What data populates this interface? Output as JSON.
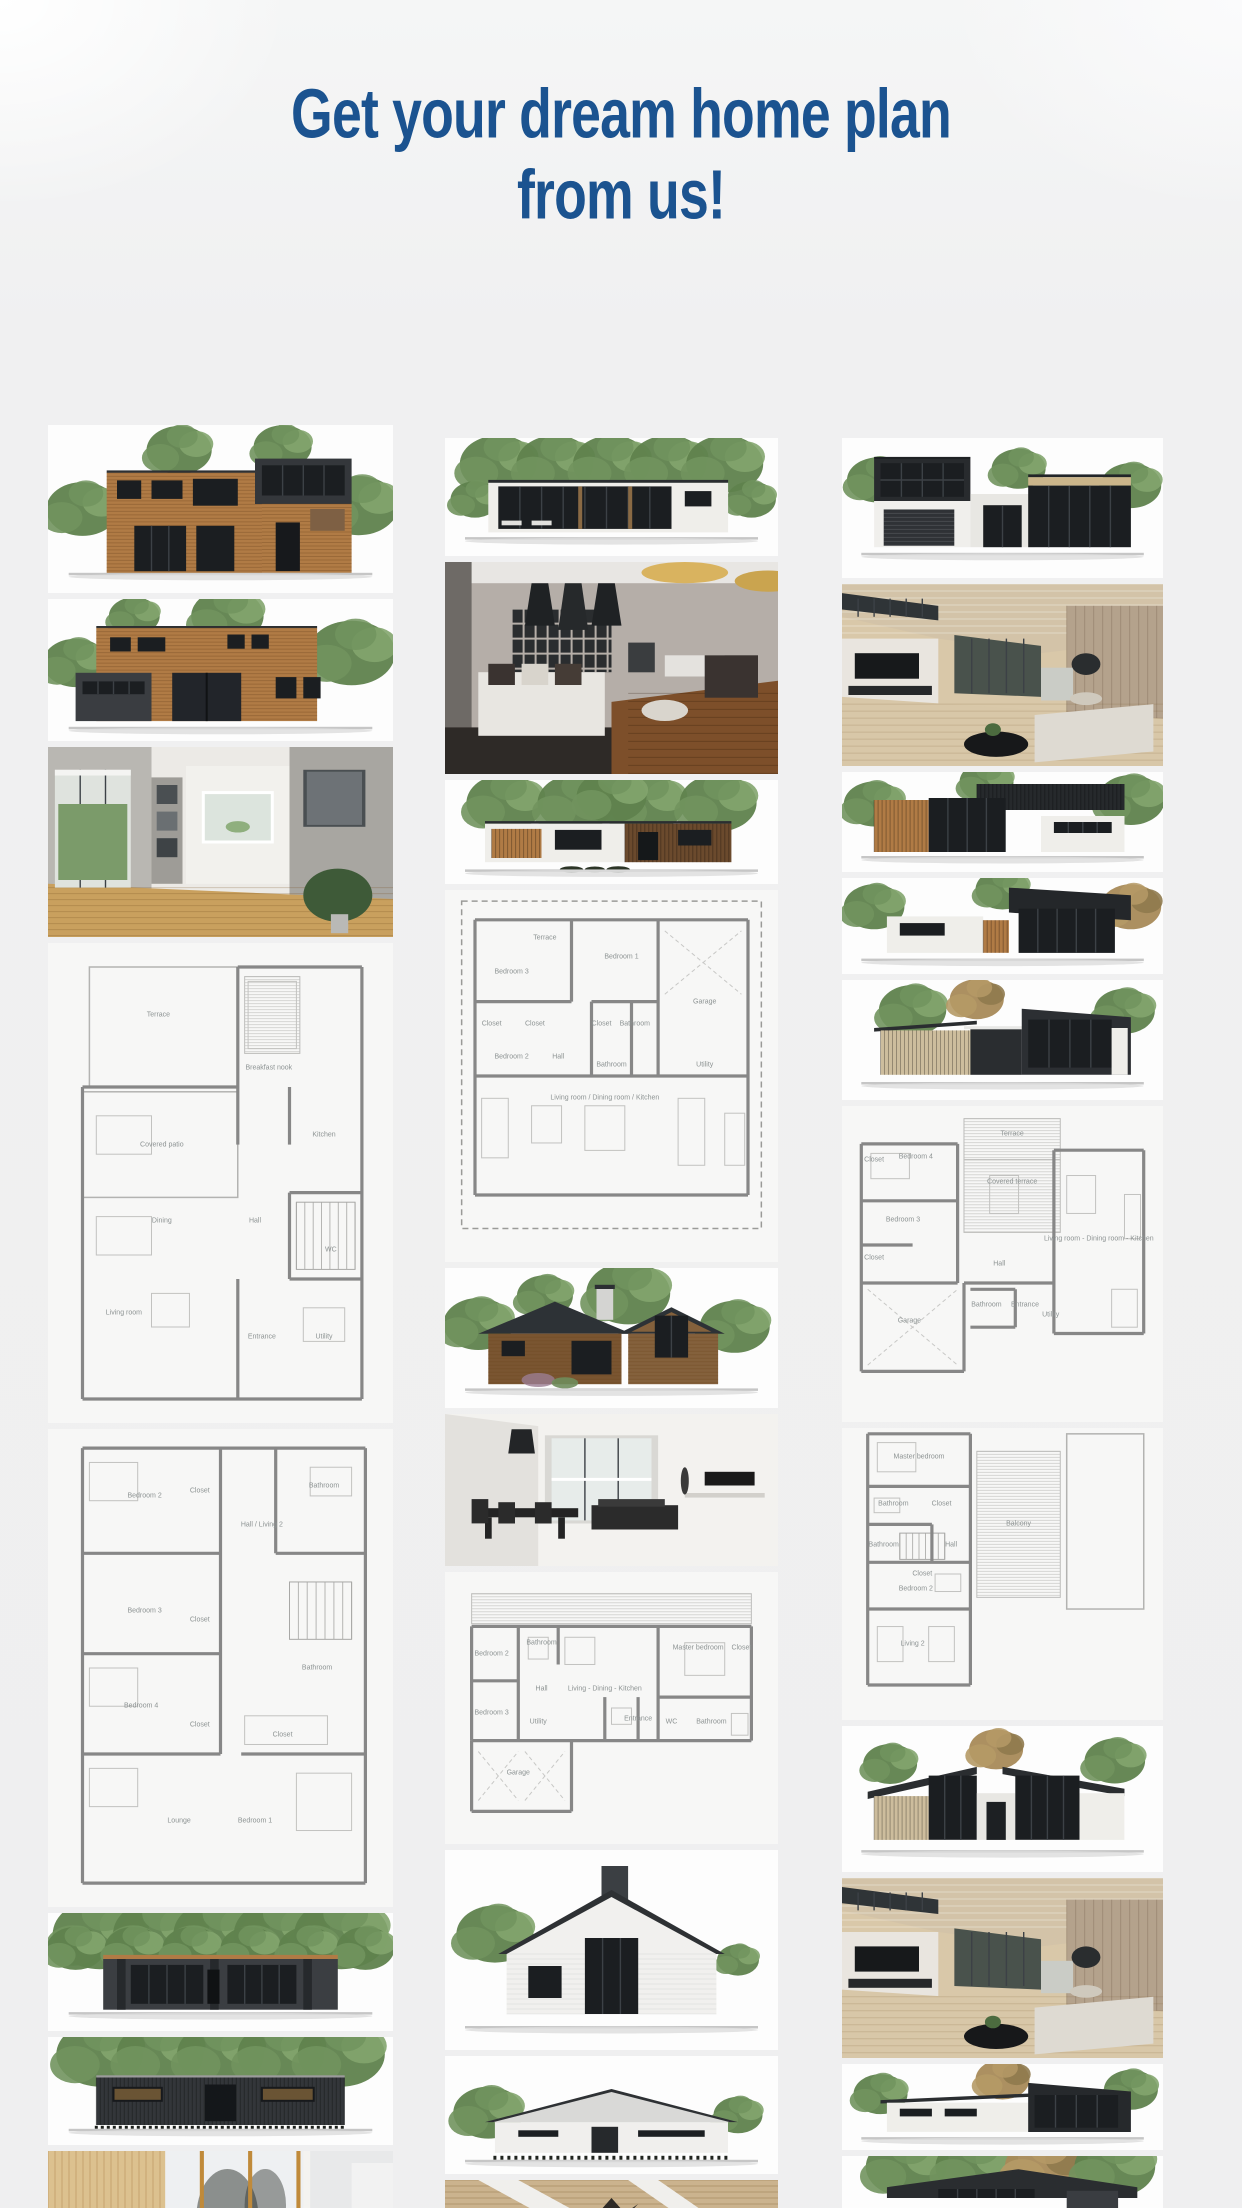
{
  "page": {
    "title": {
      "line1": "Get your dream home plan",
      "line2": "from us!"
    },
    "colors": {
      "title": "#1b5390",
      "background": "#efeff0",
      "plan_wall": "#878787",
      "wood": "#b07b45",
      "tree_green": "#6b8f5a",
      "dark_facade": "#35383c"
    }
  },
  "gallery": {
    "columns": [
      {
        "id": "left",
        "items": [
          {
            "name": "wood-two-story-house-render",
            "type": "render",
            "style": "woodhouseA"
          },
          {
            "name": "wood-house-dark-garage-render",
            "type": "render",
            "style": "woodhouseB"
          },
          {
            "name": "bright-interior-photo",
            "type": "interior",
            "style": "interiorLight"
          },
          {
            "name": "floor-plan-first-floor",
            "type": "plan",
            "plan": "c1f1",
            "rooms": [
              {
                "label": "Terrace",
                "x": 32,
                "y": 15
              },
              {
                "label": "Breakfast nook",
                "x": 64,
                "y": 26
              },
              {
                "label": "Covered patio",
                "x": 33,
                "y": 42
              },
              {
                "label": "Kitchen",
                "x": 80,
                "y": 40
              },
              {
                "label": "Dining",
                "x": 33,
                "y": 58
              },
              {
                "label": "Hall",
                "x": 60,
                "y": 58
              },
              {
                "label": "WC",
                "x": 82,
                "y": 64
              },
              {
                "label": "Living room",
                "x": 22,
                "y": 77
              },
              {
                "label": "Entrance",
                "x": 62,
                "y": 82
              },
              {
                "label": "Utility",
                "x": 80,
                "y": 82
              }
            ]
          },
          {
            "name": "floor-plan-second-floor",
            "type": "plan",
            "plan": "c1f2",
            "rooms": [
              {
                "label": "Bedroom 2",
                "x": 28,
                "y": 14
              },
              {
                "label": "Closet",
                "x": 44,
                "y": 13
              },
              {
                "label": "Hall / Living 2",
                "x": 62,
                "y": 20
              },
              {
                "label": "Bathroom",
                "x": 80,
                "y": 12
              },
              {
                "label": "Bedroom 3",
                "x": 28,
                "y": 38
              },
              {
                "label": "Closet",
                "x": 44,
                "y": 40
              },
              {
                "label": "Bedroom 4",
                "x": 27,
                "y": 58
              },
              {
                "label": "Closet",
                "x": 44,
                "y": 62
              },
              {
                "label": "Bathroom",
                "x": 78,
                "y": 50
              },
              {
                "label": "Closet",
                "x": 68,
                "y": 64
              },
              {
                "label": "Lounge",
                "x": 38,
                "y": 82
              },
              {
                "label": "Bedroom 1",
                "x": 60,
                "y": 82
              }
            ]
          },
          {
            "name": "dark-house-roof-trees-render",
            "type": "render",
            "style": "darkwideA"
          },
          {
            "name": "dark-house-elevation-render",
            "type": "render",
            "style": "darkwideB"
          },
          {
            "name": "wood-pillar-interior-photo",
            "type": "interior",
            "style": "interiorWoodPillars"
          }
        ]
      },
      {
        "id": "middle",
        "items": [
          {
            "name": "flat-roof-glass-house-render",
            "type": "render",
            "style": "flatwideWhite"
          },
          {
            "name": "dark-living-room-interior-photo",
            "type": "interior",
            "style": "interiorDark"
          },
          {
            "name": "white-wood-flat-house-render",
            "type": "render",
            "style": "flatwideWood"
          },
          {
            "name": "single-story-floor-plan",
            "type": "plan",
            "plan": "c2a",
            "rooms": [
              {
                "label": "Terrace",
                "x": 30,
                "y": 13
              },
              {
                "label": "Bedroom 1",
                "x": 53,
                "y": 18
              },
              {
                "label": "Garage",
                "x": 78,
                "y": 30
              },
              {
                "label": "Bedroom 3",
                "x": 20,
                "y": 22
              },
              {
                "label": "Closet",
                "x": 14,
                "y": 36
              },
              {
                "label": "Closet",
                "x": 27,
                "y": 36
              },
              {
                "label": "Closet",
                "x": 47,
                "y": 36
              },
              {
                "label": "Bathroom",
                "x": 57,
                "y": 36
              },
              {
                "label": "Bedroom 2",
                "x": 20,
                "y": 45
              },
              {
                "label": "Hall",
                "x": 34,
                "y": 45
              },
              {
                "label": "Bathroom",
                "x": 50,
                "y": 47
              },
              {
                "label": "Utility",
                "x": 78,
                "y": 47
              },
              {
                "label": "Living room / Dining room / Kitchen",
                "x": 48,
                "y": 56
              }
            ]
          },
          {
            "name": "gable-wood-house-render",
            "type": "render",
            "style": "gableWood"
          },
          {
            "name": "white-dining-interior-photo",
            "type": "interior",
            "style": "interiorWhite"
          },
          {
            "name": "wide-floor-plan-with-garage",
            "type": "plan",
            "plan": "c2b",
            "rooms": [
              {
                "label": "Bedroom 2",
                "x": 14,
                "y": 30
              },
              {
                "label": "Bathroom",
                "x": 29,
                "y": 26
              },
              {
                "label": "Hall",
                "x": 29,
                "y": 43
              },
              {
                "label": "Living - Dining - Kitchen",
                "x": 48,
                "y": 43
              },
              {
                "label": "Master bedroom",
                "x": 76,
                "y": 28
              },
              {
                "label": "Closet",
                "x": 89,
                "y": 28
              },
              {
                "label": "Bedroom 3",
                "x": 14,
                "y": 52
              },
              {
                "label": "Utility",
                "x": 28,
                "y": 55
              },
              {
                "label": "Entrance",
                "x": 58,
                "y": 54
              },
              {
                "label": "WC",
                "x": 68,
                "y": 55
              },
              {
                "label": "Bathroom",
                "x": 80,
                "y": 55
              },
              {
                "label": "Garage",
                "x": 22,
                "y": 74
              }
            ]
          },
          {
            "name": "white-gable-house-chimney-render",
            "type": "render",
            "style": "gableWhiteChimney"
          },
          {
            "name": "white-gable-house-render",
            "type": "render",
            "style": "gableWhiteB"
          },
          {
            "name": "wood-ceiling-interior-photo",
            "type": "interior",
            "style": "interiorWoodCeil"
          }
        ]
      },
      {
        "id": "right",
        "items": [
          {
            "name": "black-glass-modern-house-render",
            "type": "render",
            "style": "blackmixA"
          },
          {
            "name": "wood-cathedral-interior-photo",
            "type": "interior",
            "style": "interiorCathedral"
          },
          {
            "name": "black-wood-modern-house-render",
            "type": "render",
            "style": "blackmixB"
          },
          {
            "name": "black-modern-house-render",
            "type": "render",
            "style": "blackmixC"
          },
          {
            "name": "slant-roof-modern-house-render",
            "type": "render",
            "style": "slantHouseA"
          },
          {
            "name": "two-story-floor-plan-first-floor",
            "type": "plan",
            "plan": "c3f1",
            "rooms": [
              {
                "label": "Closet",
                "x": 10,
                "y": 17
              },
              {
                "label": "Bedroom 4",
                "x": 23,
                "y": 16
              },
              {
                "label": "Terrace",
                "x": 53,
                "y": 9
              },
              {
                "label": "Covered terrace",
                "x": 53,
                "y": 24
              },
              {
                "label": "Bedroom 3",
                "x": 19,
                "y": 36
              },
              {
                "label": "Closet",
                "x": 10,
                "y": 48
              },
              {
                "label": "Living room - Dining room - Kitchen",
                "x": 80,
                "y": 42
              },
              {
                "label": "Garage",
                "x": 21,
                "y": 68
              },
              {
                "label": "Hall",
                "x": 49,
                "y": 50
              },
              {
                "label": "Bathroom",
                "x": 45,
                "y": 63
              },
              {
                "label": "Entrance",
                "x": 57,
                "y": 63
              },
              {
                "label": "Utility",
                "x": 65,
                "y": 66
              }
            ]
          },
          {
            "name": "two-story-floor-plan-second-floor",
            "type": "plan",
            "plan": "c3f2",
            "rooms": [
              {
                "label": "Master bedroom",
                "x": 24,
                "y": 10
              },
              {
                "label": "Bathroom",
                "x": 16,
                "y": 26
              },
              {
                "label": "Closet",
                "x": 31,
                "y": 26
              },
              {
                "label": "Bathroom",
                "x": 13,
                "y": 40
              },
              {
                "label": "Hall",
                "x": 34,
                "y": 40
              },
              {
                "label": "Closet",
                "x": 25,
                "y": 50
              },
              {
                "label": "Bedroom 2",
                "x": 23,
                "y": 55
              },
              {
                "label": "Living 2",
                "x": 22,
                "y": 74
              },
              {
                "label": "Balcony",
                "x": 55,
                "y": 33
              }
            ]
          },
          {
            "name": "butterfly-roof-house-render",
            "type": "render",
            "style": "butterfly"
          },
          {
            "name": "wood-cathedral-interior-photo-2",
            "type": "interior",
            "style": "interiorCathedral"
          },
          {
            "name": "white-slant-glass-house-render",
            "type": "render",
            "style": "slantHouseB"
          },
          {
            "name": "dark-slant-roof-house-render",
            "type": "render",
            "style": "slantHouseC"
          }
        ]
      }
    ]
  }
}
